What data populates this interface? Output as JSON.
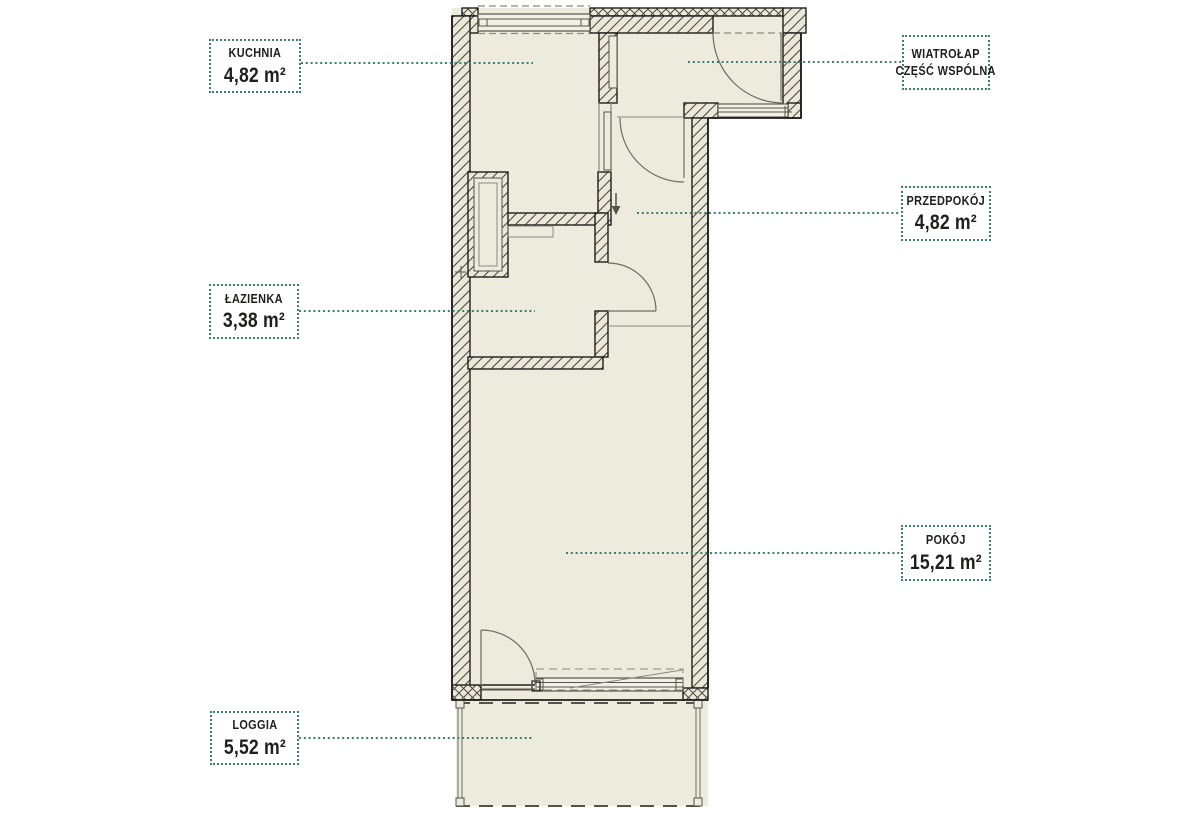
{
  "plan_type": "apartment-floor-plan",
  "rooms": [
    {
      "id": "kuchnia",
      "name": "KUCHNIA",
      "area": "4,82 m²"
    },
    {
      "id": "wiatrolap",
      "name": "WIATROŁAP",
      "name2": "CZĘŚĆ WSPÓLNA",
      "area": ""
    },
    {
      "id": "przedpokoj",
      "name": "PRZEDPOKÓJ",
      "area": "4,82 m²"
    },
    {
      "id": "lazienka",
      "name": "ŁAZIENKA",
      "area": "3,38 m²"
    },
    {
      "id": "pokoj",
      "name": "POKÓJ",
      "area": "15,21 m²"
    },
    {
      "id": "loggia",
      "name": "LOGGIA",
      "area": "5,52 m²"
    }
  ],
  "icons": {
    "entrance_arrow": "down-arrow"
  },
  "colors": {
    "leader_and_label_border": "#3a7f71",
    "room_fill": "#edeade",
    "wall_fill": "#ebe7d9",
    "hatch_line": "#4c4b43",
    "outline": "#1e1e1c",
    "label_text": "#1f1f1d"
  }
}
